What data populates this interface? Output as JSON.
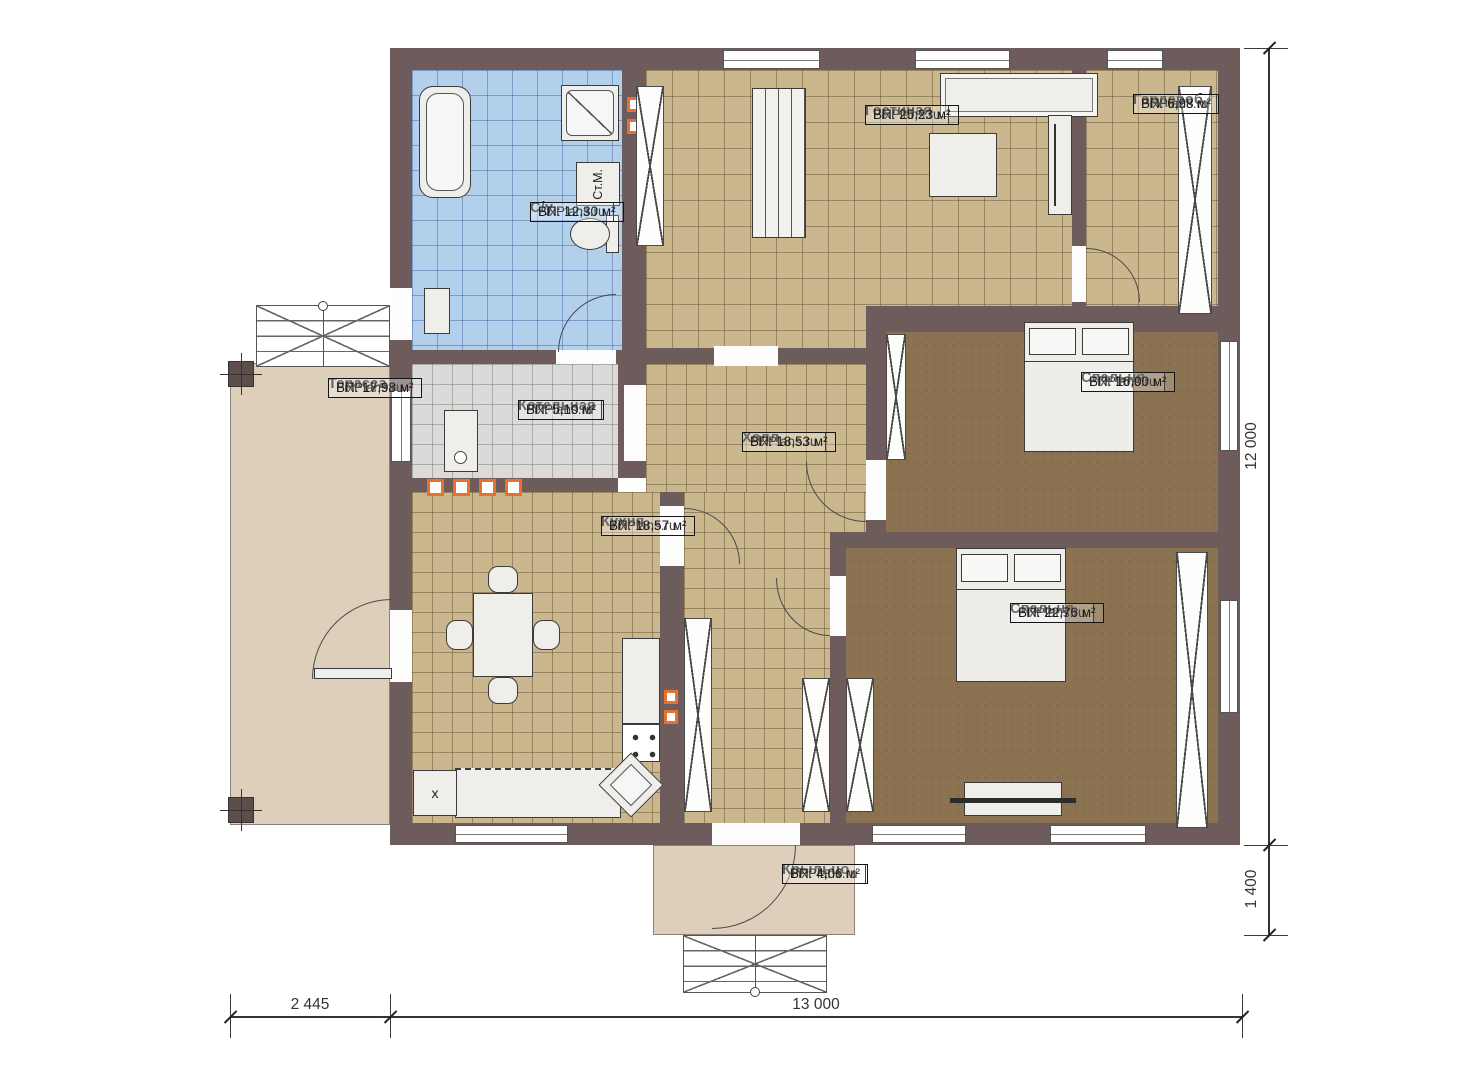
{
  "title": "Одноэтажный дом — план этажа",
  "colors": {
    "wall": "#6e5c5c",
    "floor_tan": "#cbb78e",
    "floor_blue": "#b2cfec",
    "floor_gray": "#dadad8",
    "floor_dark": "#8b7352",
    "outdoor": "#ddcfba",
    "furniture": "#efeeea",
    "outline": "#3b3b3b",
    "radiator": "#e5732f"
  },
  "rooms": [
    {
      "name": "Гостиная",
      "brand": "FixPlans.ru",
      "area": "ВП: 25,23 м²"
    },
    {
      "name": "Гардероб",
      "brand": "FixPlans.ru",
      "area": "ВП: 6,98 м²"
    },
    {
      "name": "С/у",
      "brand": "FixPlans.ru",
      "area": "ВП: 12,30 м²"
    },
    {
      "name": "Терасса",
      "brand": "FixPlans.ru",
      "area": "ВП: 17,98 м²"
    },
    {
      "name": "Котельная",
      "brand": "FixPlans.ru",
      "area": "ВП: 5,10 м²"
    },
    {
      "name": "Холл",
      "brand": "FixPlans.ru",
      "area": "ВП: 18,53 м²"
    },
    {
      "name": "Кухня",
      "brand": "FixPlans.ru",
      "area": "ВП: 18,57 м²"
    },
    {
      "name": "Спальня",
      "brand": "FixPlans.ru",
      "area": "ВП: 16,00 м²"
    },
    {
      "name": "Спальня",
      "brand": "FixPlans.ru",
      "area": "ВП: 22,76 м²"
    },
    {
      "name": "Крыльцо",
      "brand": "FixPlans.ru",
      "area": "ВП: 4,06 м²"
    }
  ],
  "dims": {
    "bottom_left": "2 445",
    "bottom_main": "13 000",
    "right_main": "12 000",
    "right_porch": "1 400"
  },
  "misc": {
    "washer": "Ст.М.",
    "sink": "x"
  }
}
